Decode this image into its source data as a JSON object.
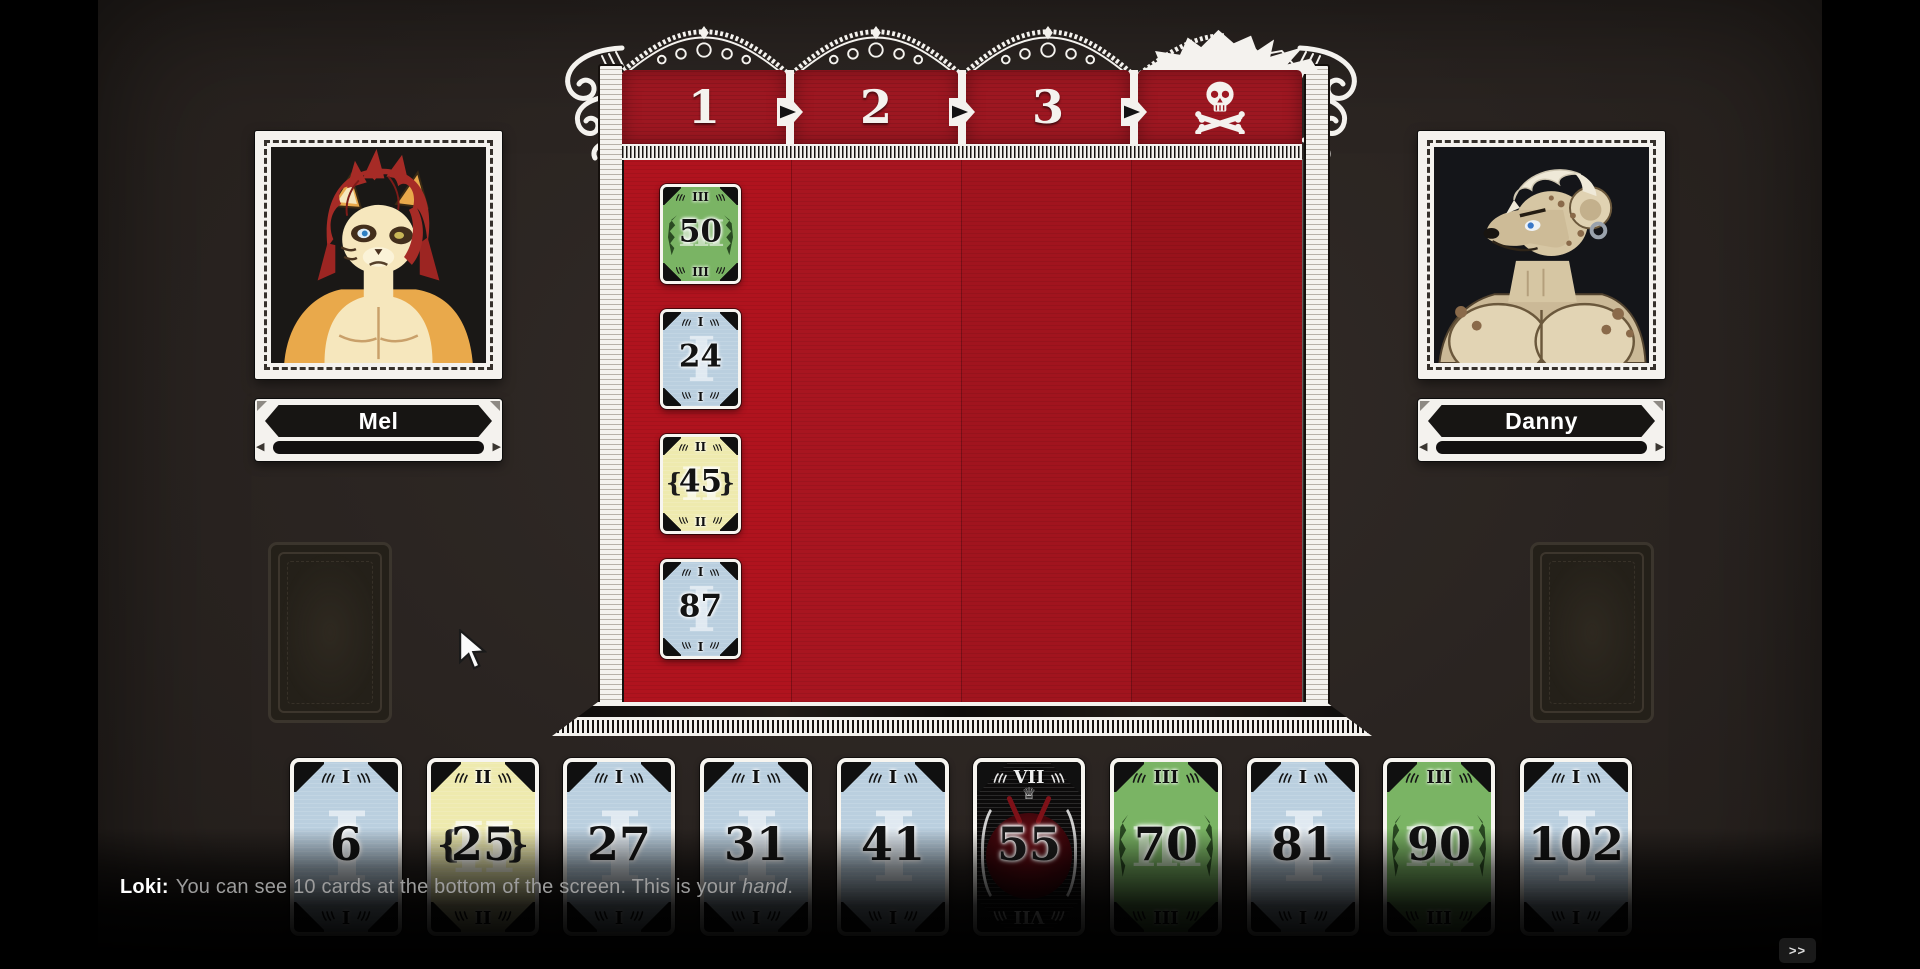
{
  "board": {
    "round_columns": [
      {
        "label": "1"
      },
      {
        "label": "2"
      },
      {
        "label": "3"
      },
      {
        "label": "",
        "icon": "skull-crossbones"
      }
    ],
    "column_1_cards": [
      {
        "value": "50",
        "tier": "III",
        "color": "green"
      },
      {
        "value": "24",
        "tier": "I",
        "color": "blue"
      },
      {
        "value": "45",
        "tier": "II",
        "color": "yellow"
      },
      {
        "value": "87",
        "tier": "I",
        "color": "blue"
      }
    ]
  },
  "players": {
    "left": {
      "name": "Mel"
    },
    "right": {
      "name": "Danny"
    }
  },
  "hand": {
    "cards": [
      {
        "value": "6",
        "tier": "I",
        "color": "blue"
      },
      {
        "value": "25",
        "tier": "II",
        "color": "yellow"
      },
      {
        "value": "27",
        "tier": "I",
        "color": "blue"
      },
      {
        "value": "31",
        "tier": "I",
        "color": "blue"
      },
      {
        "value": "41",
        "tier": "I",
        "color": "blue"
      },
      {
        "value": "55",
        "tier": "VII",
        "color": "black"
      },
      {
        "value": "70",
        "tier": "III",
        "color": "green"
      },
      {
        "value": "81",
        "tier": "I",
        "color": "blue"
      },
      {
        "value": "90",
        "tier": "III",
        "color": "green"
      },
      {
        "value": "102",
        "tier": "I",
        "color": "blue"
      }
    ]
  },
  "tutorial": {
    "speaker": "Loki:",
    "message_prefix": "You can see 10 cards at the bottom of the screen. This is your ",
    "message_italic": "hand",
    "message_suffix": ".",
    "advance_button": ">>"
  },
  "colors": {
    "board_red": "#a81520",
    "header_red": "#9d1721",
    "card_blue": "#bacfdf",
    "card_yellow": "#eeeaae",
    "card_green": "#7ab464",
    "card_black": "#0c0b0b",
    "lace_white": "#f4f2ee",
    "background": "#2a2421"
  }
}
